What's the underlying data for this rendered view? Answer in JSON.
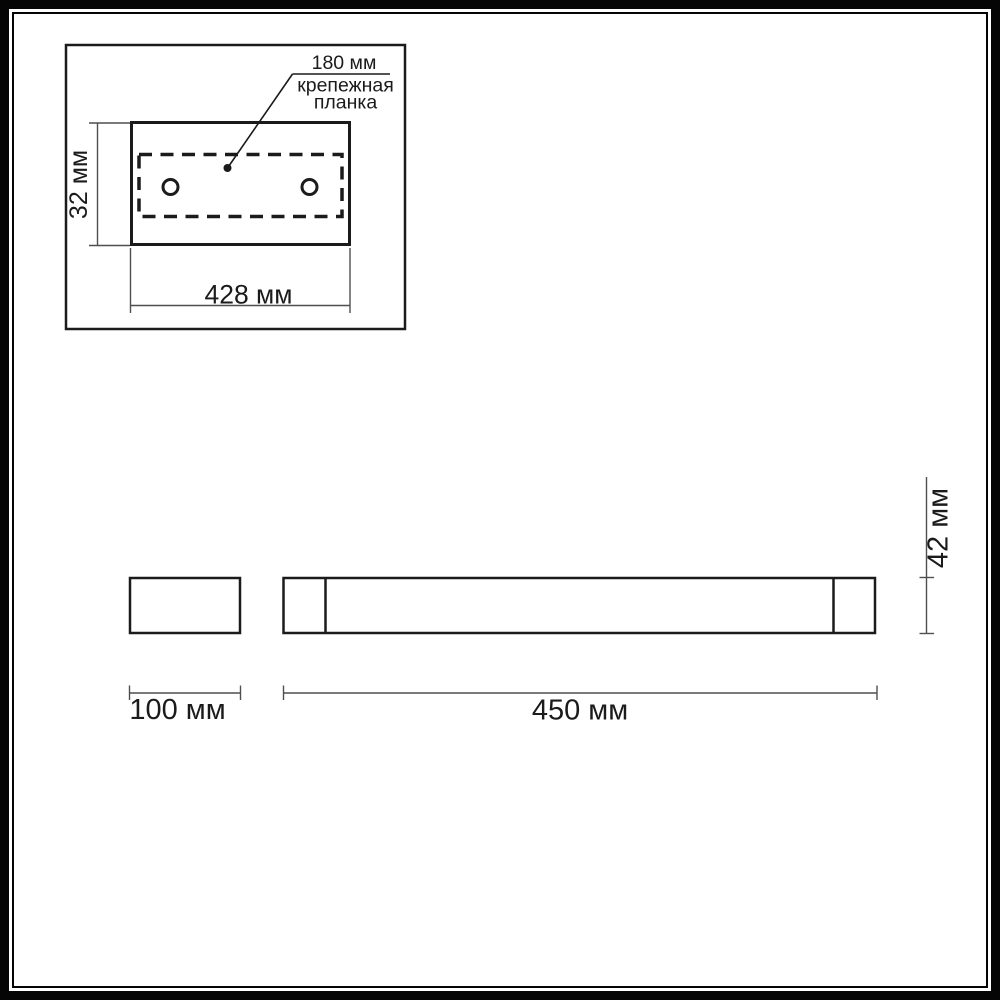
{
  "colors": {
    "ink": "#1b1b1b",
    "dim_line": "#4f4f4f",
    "background": "#ffffff"
  },
  "detail_view": {
    "hole_spacing_label": "180 мм",
    "part_label_line1": "крепежная",
    "part_label_line2": "планка",
    "plate_height_label": "32 мм",
    "plate_width_label": "428 мм"
  },
  "side_view": {
    "depth_label": "100 мм"
  },
  "front_view": {
    "width_label": "450 мм",
    "height_label": "42 мм"
  }
}
